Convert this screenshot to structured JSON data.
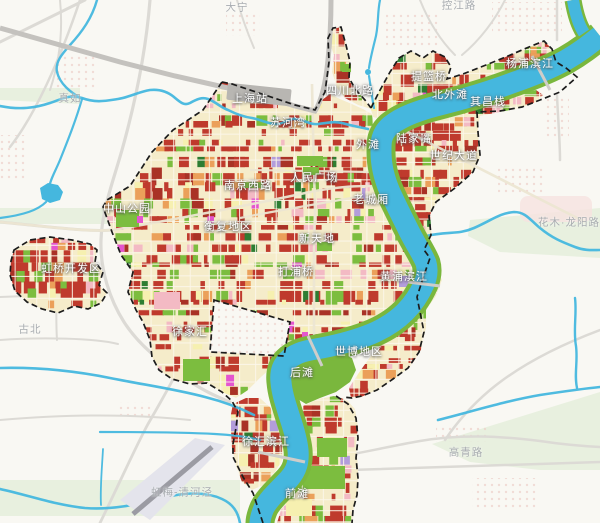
{
  "map": {
    "district_labels": [
      {
        "text": "上海站",
        "x": 250,
        "y": 98
      },
      {
        "text": "苏河湾",
        "x": 288,
        "y": 122
      },
      {
        "text": "四川北路",
        "x": 350,
        "y": 90
      },
      {
        "text": "提篮桥",
        "x": 429,
        "y": 76
      },
      {
        "text": "杨浦滨江",
        "x": 530,
        "y": 63
      },
      {
        "text": "北外滩",
        "x": 450,
        "y": 94
      },
      {
        "text": "其昌栈",
        "x": 488,
        "y": 101
      },
      {
        "text": "外滩",
        "x": 368,
        "y": 144
      },
      {
        "text": "陆家嘴",
        "x": 414,
        "y": 138
      },
      {
        "text": "世纪大道",
        "x": 454,
        "y": 155
      },
      {
        "text": "人民广场",
        "x": 314,
        "y": 177
      },
      {
        "text": "南京西路",
        "x": 248,
        "y": 185
      },
      {
        "text": "中山公园",
        "x": 127,
        "y": 208
      },
      {
        "text": "老城厢",
        "x": 371,
        "y": 199
      },
      {
        "text": "衡复地区",
        "x": 228,
        "y": 226
      },
      {
        "text": "新天地",
        "x": 317,
        "y": 238
      },
      {
        "text": "虹桥开发区",
        "x": 71,
        "y": 268
      },
      {
        "text": "打浦桥",
        "x": 296,
        "y": 271
      },
      {
        "text": "黄浦滨江",
        "x": 404,
        "y": 276
      },
      {
        "text": "徐家汇",
        "x": 190,
        "y": 331
      },
      {
        "text": "世博地区",
        "x": 359,
        "y": 351
      },
      {
        "text": "后滩",
        "x": 302,
        "y": 372
      },
      {
        "text": "徐汇滨江",
        "x": 266,
        "y": 441
      },
      {
        "text": "前滩",
        "x": 297,
        "y": 493
      }
    ],
    "background_labels": [
      {
        "text": "大宁",
        "x": 237,
        "y": 7
      },
      {
        "text": "控江路",
        "x": 459,
        "y": 5
      },
      {
        "text": "真如",
        "x": 70,
        "y": 98
      },
      {
        "text": "古北",
        "x": 30,
        "y": 329
      },
      {
        "text": "花木·龙阳路",
        "x": 569,
        "y": 222
      },
      {
        "text": "高青路",
        "x": 466,
        "y": 452
      },
      {
        "text": "虹梅-清河泾",
        "x": 182,
        "y": 492
      }
    ],
    "palette": {
      "background": "#f9f8f3",
      "background_green": "#e2eed8",
      "background_pink": "#f6e2e0",
      "dot_pink": "#eccdc6",
      "water": "#45b7de",
      "bank_green": "#7ab73d",
      "urban_base": "#f5ecca",
      "street_white": "#fcf7ea",
      "parcel_red": "#bf3a2d",
      "parcel_dark_red": "#a93226",
      "parcel_green": "#7cbd3f",
      "parcel_dark_green": "#2e7d32",
      "parcel_orange": "#eba05a",
      "parcel_pink": "#f3bac4",
      "parcel_yellow": "#f6f0b0",
      "parcel_magenta": "#e455cf",
      "parcel_purple": "#b39ddb",
      "road_gray": "#dcdad5",
      "road_beige": "#ece6d2",
      "railway_gray": "#c4c2be",
      "station_gray": "#b8b6b2",
      "airport_gray": "#e4e4ec",
      "runway_gray": "#9b9ba3",
      "boundary_black": "#1c1c1c",
      "label_white": "#ffffff",
      "label_gray": "#a8acb0"
    }
  }
}
